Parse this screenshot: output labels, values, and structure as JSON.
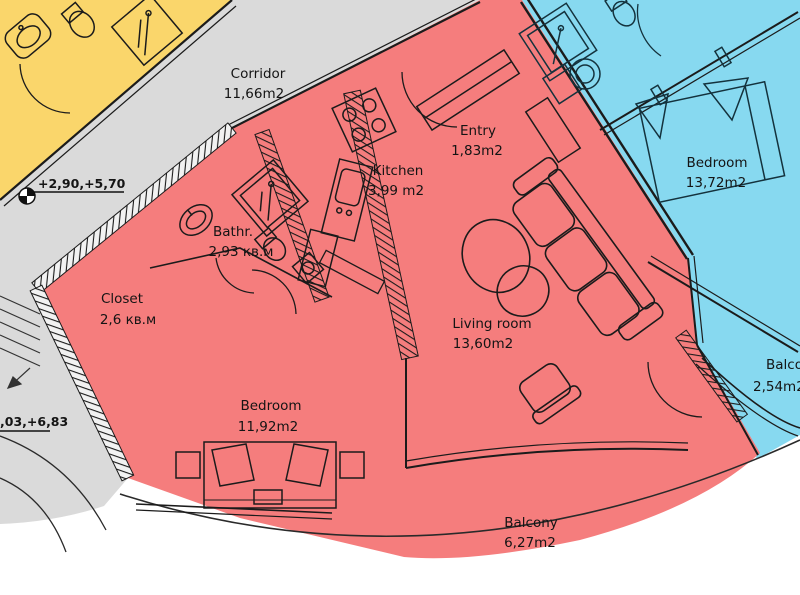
{
  "colors": {
    "apartment_highlight": "#F57D7D",
    "neighbor_apartment": "#87D9F0",
    "other_apartment": "#FAD66B",
    "common_area": "#DADADA",
    "outline": "#1B1B1B"
  },
  "rooms": {
    "corridor": {
      "name": "Corridor",
      "area": "11,66m2"
    },
    "entry": {
      "name": "Entry",
      "area": "1,83m2"
    },
    "kitchen": {
      "name": "Kitchen",
      "area": "3,99 m2"
    },
    "bathroom": {
      "name": "Bathr.",
      "area": "2,93 кв.м"
    },
    "closet": {
      "name": "Closet",
      "area": "2,6 кв.м"
    },
    "living_room": {
      "name": "Living room",
      "area": "13,60m2"
    },
    "bedroom": {
      "name": "Bedroom",
      "area": "11,92m2"
    },
    "balcony": {
      "name": "Balcony",
      "area": "6,27m2"
    },
    "neighbor_bedroom": {
      "name": "Bedroom",
      "area": "13,72m2"
    },
    "neighbor_balcony": {
      "name": "Balcony",
      "area": "2,54m2"
    }
  },
  "annotations": {
    "level_mark_upper": "+2,90,+5,70",
    "level_mark_lower": ",03,+6,83"
  }
}
